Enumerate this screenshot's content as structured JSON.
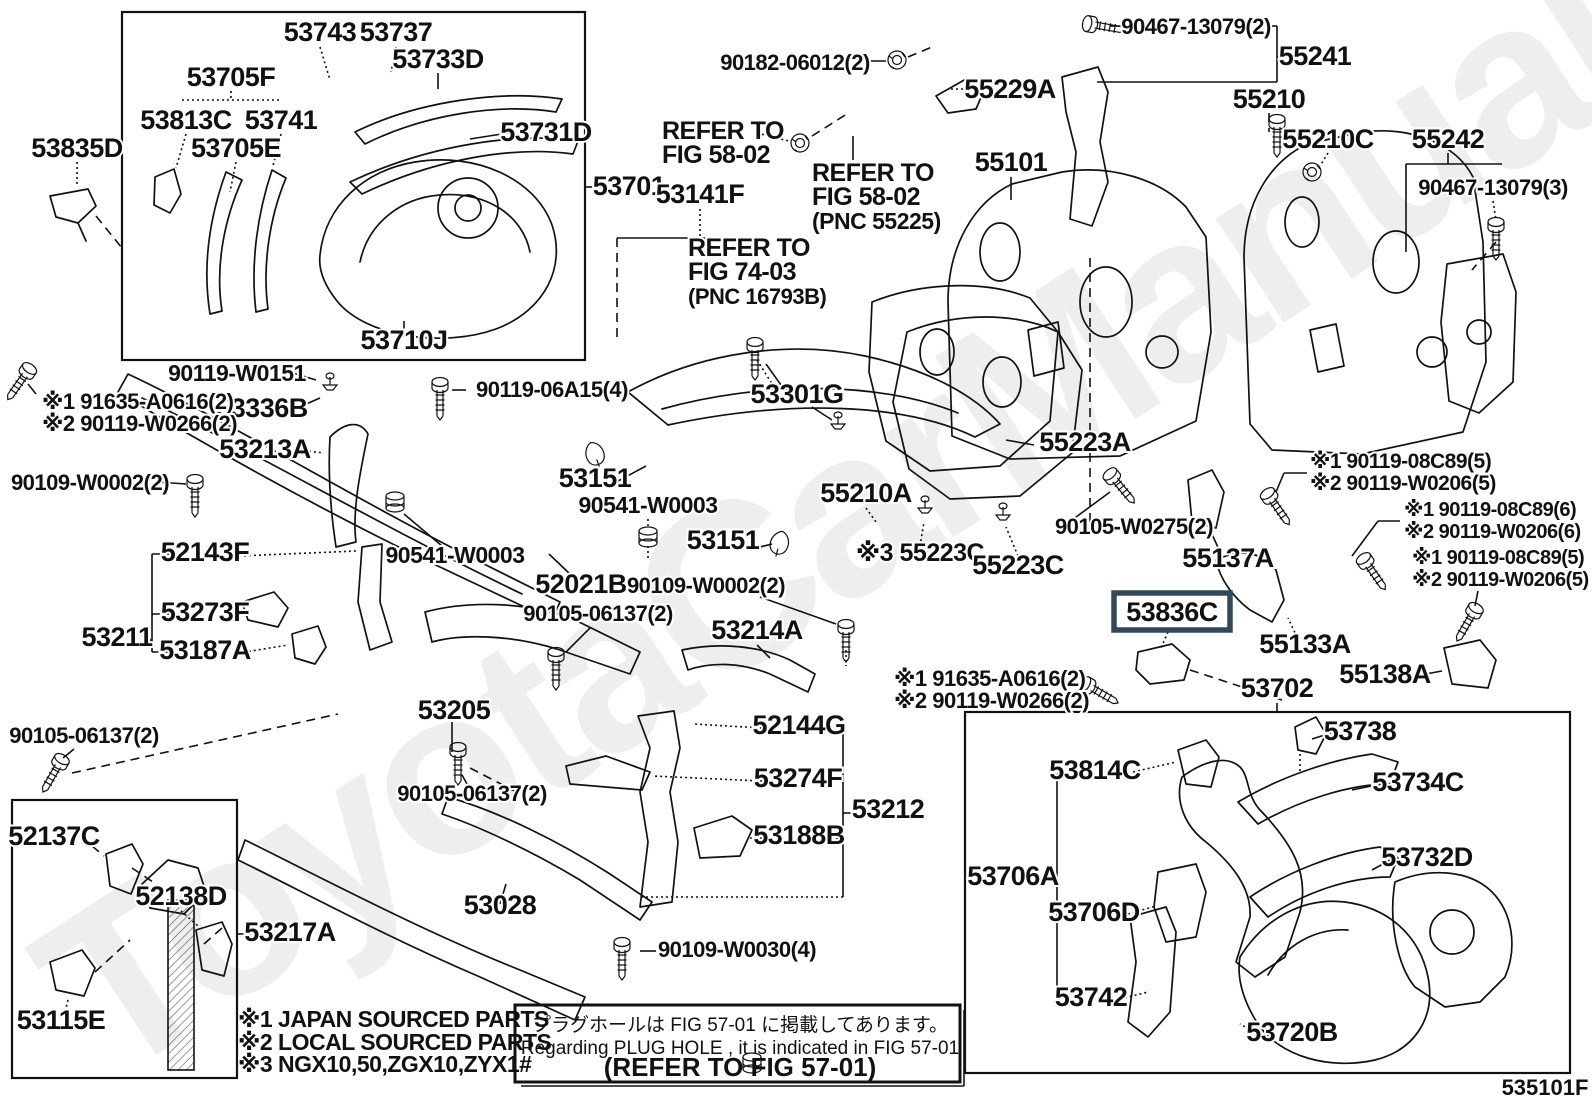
{
  "figure": {
    "id_label": "535101F",
    "watermark": "ToyotaCarManuals.ru",
    "highlight_color": "#32495c",
    "highlighted_part": "53836C"
  },
  "notes": {
    "legend": [
      "※1 JAPAN SOURCED PARTS",
      "※2 LOCAL SOURCED PARTS",
      "※3 NGX10,50,ZGX10,ZYX1#"
    ],
    "plug_hole": {
      "jp": "プラグホールは FIG 57-01 に掲載してあります。",
      "en": "Regarding  PLUG  HOLE , it is indicated in  FIG  57-01",
      "ref": "(REFER TO FIG 57-01)"
    }
  },
  "labels": [
    {
      "t": "53743",
      "x": 320,
      "y": 41
    },
    {
      "t": "53737",
      "x": 396,
      "y": 41
    },
    {
      "t": "53733D",
      "x": 438,
      "y": 68
    },
    {
      "t": "53705F",
      "x": 231,
      "y": 86
    },
    {
      "t": "53813C",
      "x": 186,
      "y": 129
    },
    {
      "t": "53741",
      "x": 281,
      "y": 129
    },
    {
      "t": "53705E",
      "x": 236,
      "y": 157
    },
    {
      "t": "53731D",
      "x": 546,
      "y": 141
    },
    {
      "t": "53835D",
      "x": 77,
      "y": 157
    },
    {
      "t": "53710J",
      "x": 404,
      "y": 349
    },
    {
      "t": "53701",
      "x": 629,
      "y": 195
    },
    {
      "t": "90182-06012(2)",
      "x": 795,
      "y": 70
    },
    {
      "t": "55229A",
      "x": 1010,
      "y": 98
    },
    {
      "t": "55101",
      "x": 1011,
      "y": 171
    },
    {
      "t": "90467-13079(2)",
      "x": 1196,
      "y": 34
    },
    {
      "t": "55241",
      "x": 1315,
      "y": 65
    },
    {
      "t": "55210",
      "x": 1269,
      "y": 108
    },
    {
      "t": "55210C",
      "x": 1328,
      "y": 148
    },
    {
      "t": "55242",
      "x": 1448,
      "y": 148
    },
    {
      "t": "90467-13079(3)",
      "x": 1493,
      "y": 195
    },
    {
      "t": "53141F",
      "x": 700,
      "y": 203
    },
    {
      "t": "REFER TO",
      "x": 662,
      "y": 139,
      "a": "s",
      "k": "n"
    },
    {
      "t": "FIG 58-02",
      "x": 662,
      "y": 163,
      "a": "s",
      "k": "n"
    },
    {
      "t": "REFER TO",
      "x": 812,
      "y": 181,
      "a": "s",
      "k": "n"
    },
    {
      "t": "FIG 58-02",
      "x": 812,
      "y": 205,
      "a": "s",
      "k": "n"
    },
    {
      "t": "(PNC 55225)",
      "x": 812,
      "y": 229,
      "a": "s",
      "k": "n"
    },
    {
      "t": "REFER TO",
      "x": 688,
      "y": 256,
      "a": "s",
      "k": "n"
    },
    {
      "t": "FIG 74-03",
      "x": 688,
      "y": 280,
      "a": "s",
      "k": "n"
    },
    {
      "t": "(PNC 16793B)",
      "x": 688,
      "y": 304,
      "a": "s",
      "k": "n"
    },
    {
      "t": "90119-W0151",
      "x": 237,
      "y": 381
    },
    {
      "t": "53336B",
      "x": 262,
      "y": 417
    },
    {
      "t": "53213A",
      "x": 265,
      "y": 458
    },
    {
      "t": "90109-W0002(2)",
      "x": 90,
      "y": 490
    },
    {
      "t": "※1 91635-A0616(2)",
      "x": 42,
      "y": 409,
      "a": "s",
      "s": 22
    },
    {
      "t": "※2 90119-W0266(2)",
      "x": 42,
      "y": 431,
      "a": "s",
      "s": 22
    },
    {
      "t": "52143F",
      "x": 205,
      "y": 561
    },
    {
      "t": "90541-W0003",
      "x": 455,
      "y": 563
    },
    {
      "t": "53273F",
      "x": 205,
      "y": 621
    },
    {
      "t": "53211",
      "x": 117,
      "y": 646
    },
    {
      "t": "53187A",
      "x": 205,
      "y": 659
    },
    {
      "t": "90105-06137(2)",
      "x": 84,
      "y": 743
    },
    {
      "t": "90119-06A15(4)",
      "x": 552,
      "y": 397
    },
    {
      "t": "53151",
      "x": 595,
      "y": 487
    },
    {
      "t": "90541-W0003",
      "x": 648,
      "y": 513
    },
    {
      "t": "53301G",
      "x": 797,
      "y": 403
    },
    {
      "t": "55210A",
      "x": 866,
      "y": 502
    },
    {
      "t": "53151",
      "x": 723,
      "y": 549
    },
    {
      "t": "52021B",
      "x": 581,
      "y": 593
    },
    {
      "t": "90109-W0002(2)",
      "x": 706,
      "y": 593
    },
    {
      "t": "90105-06137(2)",
      "x": 598,
      "y": 621
    },
    {
      "t": "53214A",
      "x": 757,
      "y": 639
    },
    {
      "t": "53205",
      "x": 454,
      "y": 719
    },
    {
      "t": "52144G",
      "x": 799,
      "y": 734
    },
    {
      "t": "53274F",
      "x": 798,
      "y": 787
    },
    {
      "t": "53212",
      "x": 888,
      "y": 818
    },
    {
      "t": "53188B",
      "x": 799,
      "y": 844
    },
    {
      "t": "90105-06137(2)",
      "x": 472,
      "y": 801
    },
    {
      "t": "53028",
      "x": 500,
      "y": 914
    },
    {
      "t": "90109-W0030(4)",
      "x": 737,
      "y": 957
    },
    {
      "t": "55223A",
      "x": 1085,
      "y": 451
    },
    {
      "t": "※3 55223C",
      "x": 920,
      "y": 561,
      "s": 25
    },
    {
      "t": "55223C",
      "x": 1018,
      "y": 574
    },
    {
      "t": "90105-W0275(2)",
      "x": 1134,
      "y": 534
    },
    {
      "t": "55137A",
      "x": 1228,
      "y": 567
    },
    {
      "t": "※1 90119-08C89(5)",
      "x": 1310,
      "y": 468,
      "a": "s",
      "s": 21
    },
    {
      "t": "※2 90119-W0206(5)",
      "x": 1310,
      "y": 490,
      "a": "s",
      "s": 21
    },
    {
      "t": "※1 90119-08C89(6)",
      "x": 1404,
      "y": 516,
      "a": "s",
      "s": 20
    },
    {
      "t": "※2 90119-W0206(6)",
      "x": 1404,
      "y": 538,
      "a": "s",
      "s": 20
    },
    {
      "t": "※1 90119-08C89(5)",
      "x": 1412,
      "y": 564,
      "a": "s",
      "s": 20
    },
    {
      "t": "※2 90119-W0206(5)",
      "x": 1412,
      "y": 586,
      "a": "s",
      "s": 20
    },
    {
      "t": "53836C",
      "x": 1172,
      "y": 621,
      "hl": true
    },
    {
      "t": "55133A",
      "x": 1305,
      "y": 653
    },
    {
      "t": "55138A",
      "x": 1385,
      "y": 683
    },
    {
      "t": "※1 91635-A0616(2)",
      "x": 894,
      "y": 686,
      "a": "s",
      "s": 22
    },
    {
      "t": "※2 90119-W0266(2)",
      "x": 894,
      "y": 708,
      "a": "s",
      "s": 22
    },
    {
      "t": "53702",
      "x": 1277,
      "y": 697
    },
    {
      "t": "52137C",
      "x": 54,
      "y": 845
    },
    {
      "t": "52138D",
      "x": 181,
      "y": 905
    },
    {
      "t": "53217A",
      "x": 290,
      "y": 941
    },
    {
      "t": "53115E",
      "x": 61,
      "y": 1029
    },
    {
      "t": "53738",
      "x": 1360,
      "y": 740
    },
    {
      "t": "53814C",
      "x": 1095,
      "y": 779
    },
    {
      "t": "53734C",
      "x": 1418,
      "y": 791
    },
    {
      "t": "53706A",
      "x": 1013,
      "y": 885
    },
    {
      "t": "53732D",
      "x": 1427,
      "y": 866
    },
    {
      "t": "53706D",
      "x": 1094,
      "y": 921
    },
    {
      "t": "53742",
      "x": 1091,
      "y": 1006
    },
    {
      "t": "53720B",
      "x": 1292,
      "y": 1041
    }
  ]
}
